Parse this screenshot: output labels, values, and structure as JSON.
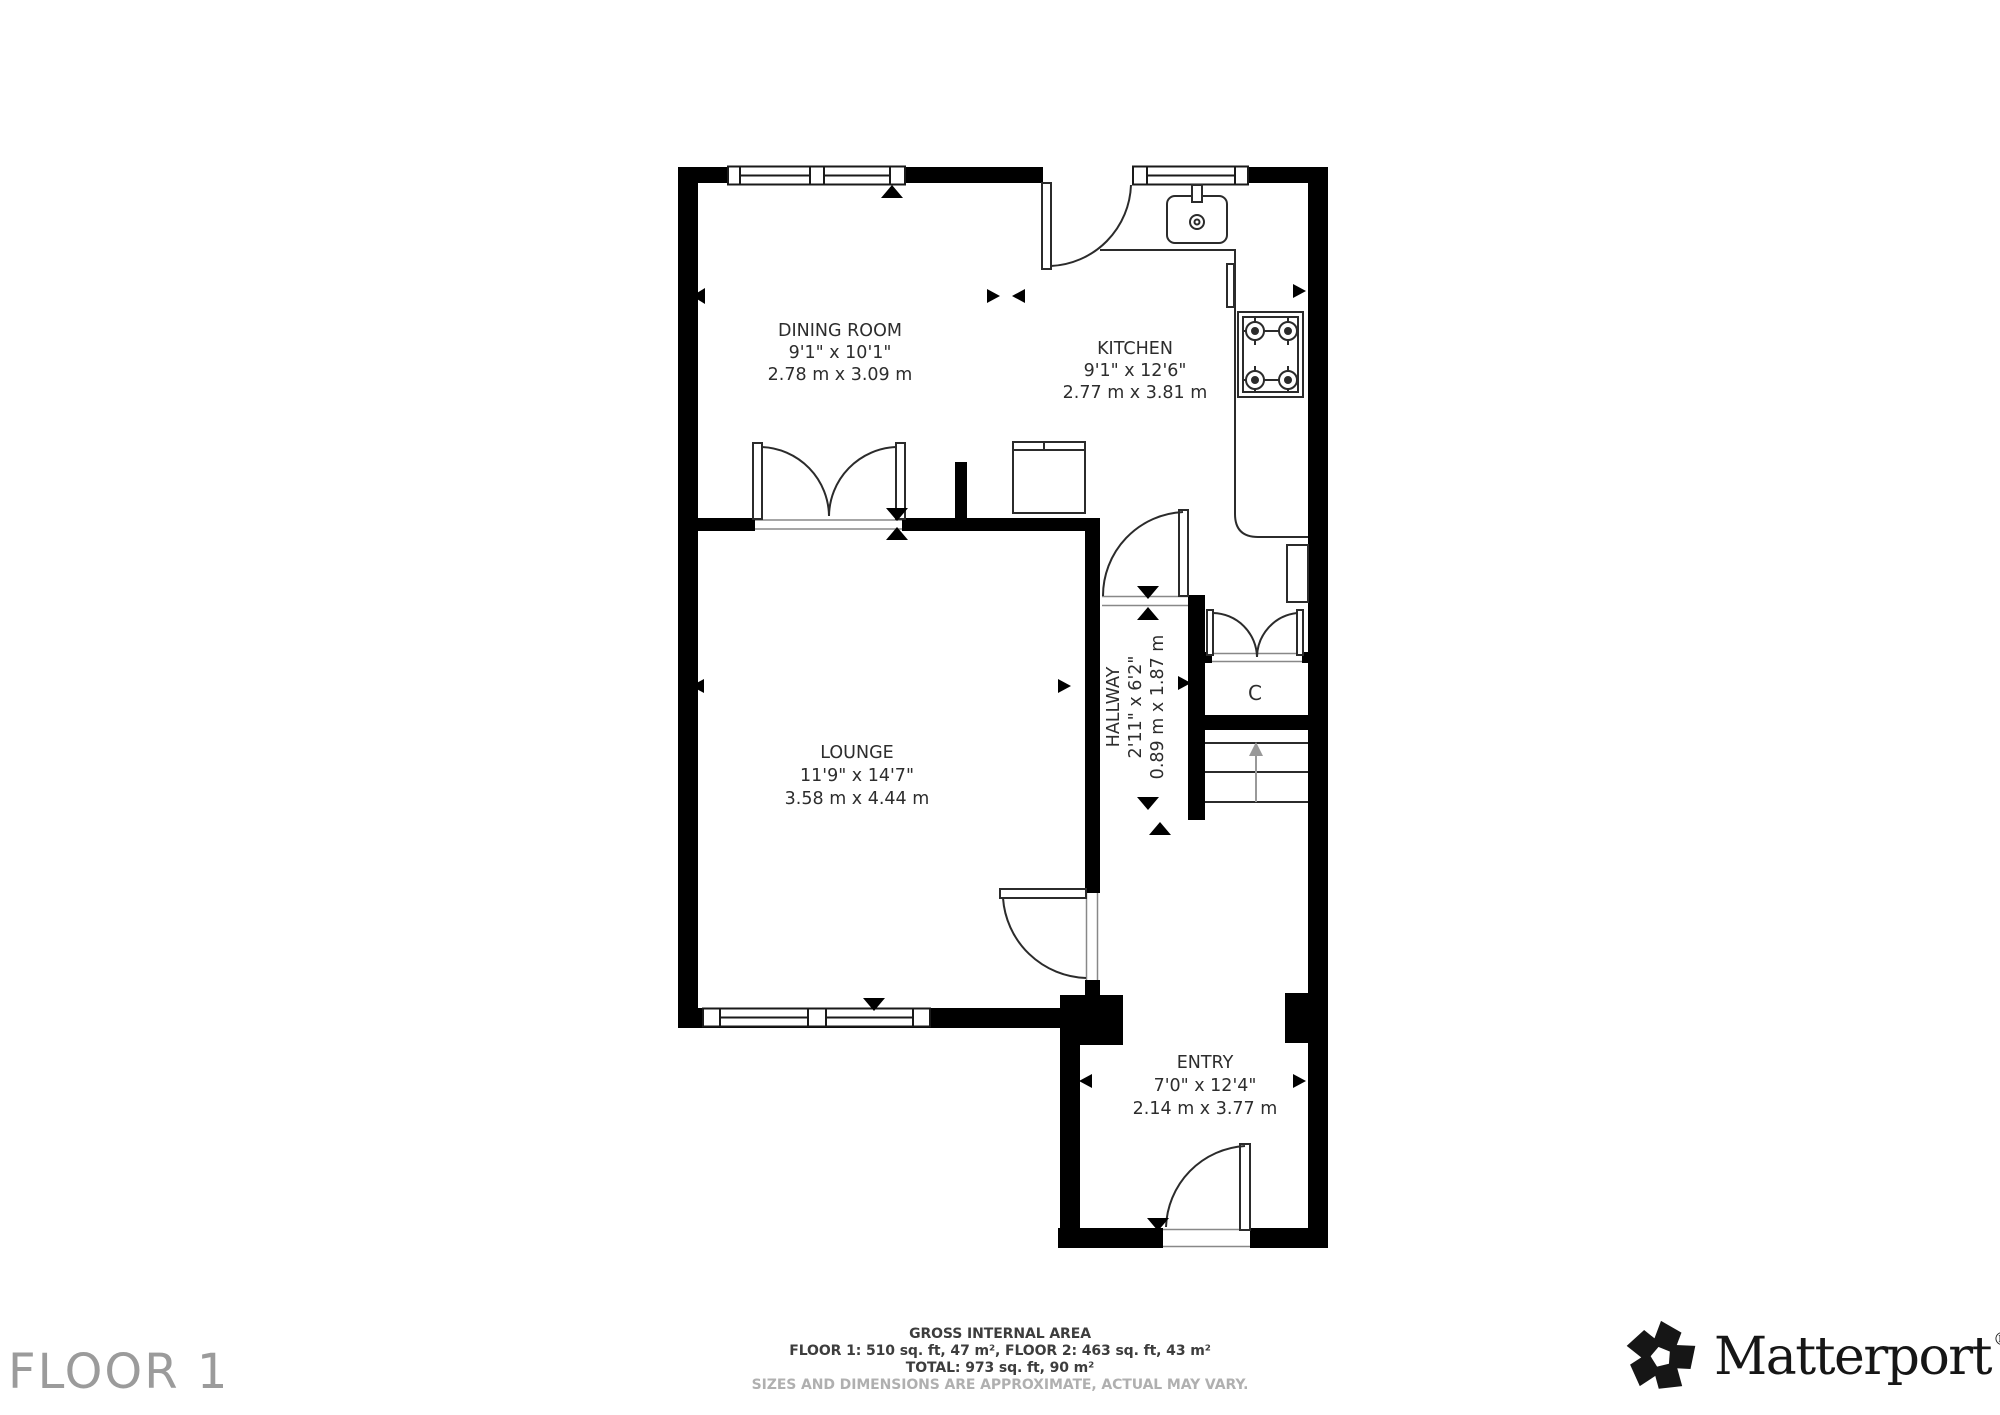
{
  "plan": {
    "rooms": {
      "dining": {
        "name": "DINING ROOM",
        "imperial": "9'1\" x 10'1\"",
        "metric": "2.78 m x 3.09 m"
      },
      "kitchen": {
        "name": "KITCHEN",
        "imperial": "9'1\" x 12'6\"",
        "metric": "2.77 m x 3.81 m"
      },
      "lounge": {
        "name": "LOUNGE",
        "imperial": "11'9\" x 14'7\"",
        "metric": "3.58 m x 4.44 m"
      },
      "hallway": {
        "name": "HALLWAY",
        "imperial": "2'11\" x 6'2\"",
        "metric": "0.89 m x 1.87 m"
      },
      "entry": {
        "name": "ENTRY",
        "imperial": "7'0\" x 12'4\"",
        "metric": "2.14 m x 3.77 m"
      },
      "closet": {
        "label": "C"
      }
    }
  },
  "footer": {
    "title": "GROSS INTERNAL AREA",
    "line1": "FLOOR 1: 510 sq. ft, 47 m², FLOOR 2: 463 sq. ft, 43 m²",
    "line2": "TOTAL: 973 sq. ft, 90 m²",
    "disclaimer": "SIZES AND DIMENSIONS ARE APPROXIMATE, ACTUAL MAY VARY."
  },
  "floor_label": "FLOOR 1",
  "brand": {
    "name": "Matterport",
    "registered": "®"
  },
  "colors": {
    "walls": "#000000",
    "room_label": "#2d2d2d",
    "floor_label": "#9b9b9b",
    "disclaimer": "#b0b0b0",
    "stairs_arrow": "#999999"
  }
}
